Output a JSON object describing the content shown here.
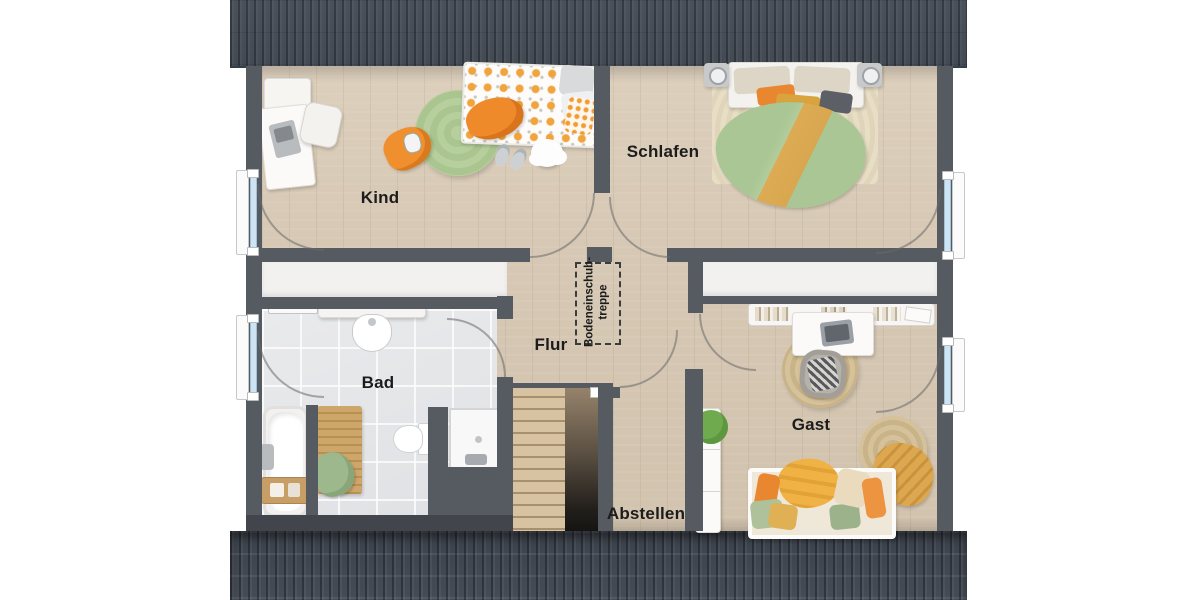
{
  "plan": {
    "type": "floor-plan",
    "rooms": [
      {
        "id": "kind",
        "label": "Kind"
      },
      {
        "id": "schlafen",
        "label": "Schlafen"
      },
      {
        "id": "flur",
        "label": "Flur"
      },
      {
        "id": "bad",
        "label": "Bad"
      },
      {
        "id": "gast",
        "label": "Gast"
      },
      {
        "id": "abstellen",
        "label": "Abstellen"
      }
    ],
    "attic_hatch": {
      "line1": "Bodeneinschub-",
      "line2": "treppe"
    },
    "colors": {
      "roof": "#454b54",
      "wall": "#565b62",
      "wood_floor": "#d6c8b4",
      "tile_floor": "#e4e5e7",
      "knee_wall_white": "#f2f1ef",
      "window_glass": "#cfe4f3",
      "accent_orange": "#ef8a2b",
      "accent_mustard": "#dcab54",
      "accent_sage": "#a9c694",
      "rug_green": "#b3cc97",
      "rug_jute": "#d3bf98",
      "stair_wood": "#c9b392"
    }
  }
}
